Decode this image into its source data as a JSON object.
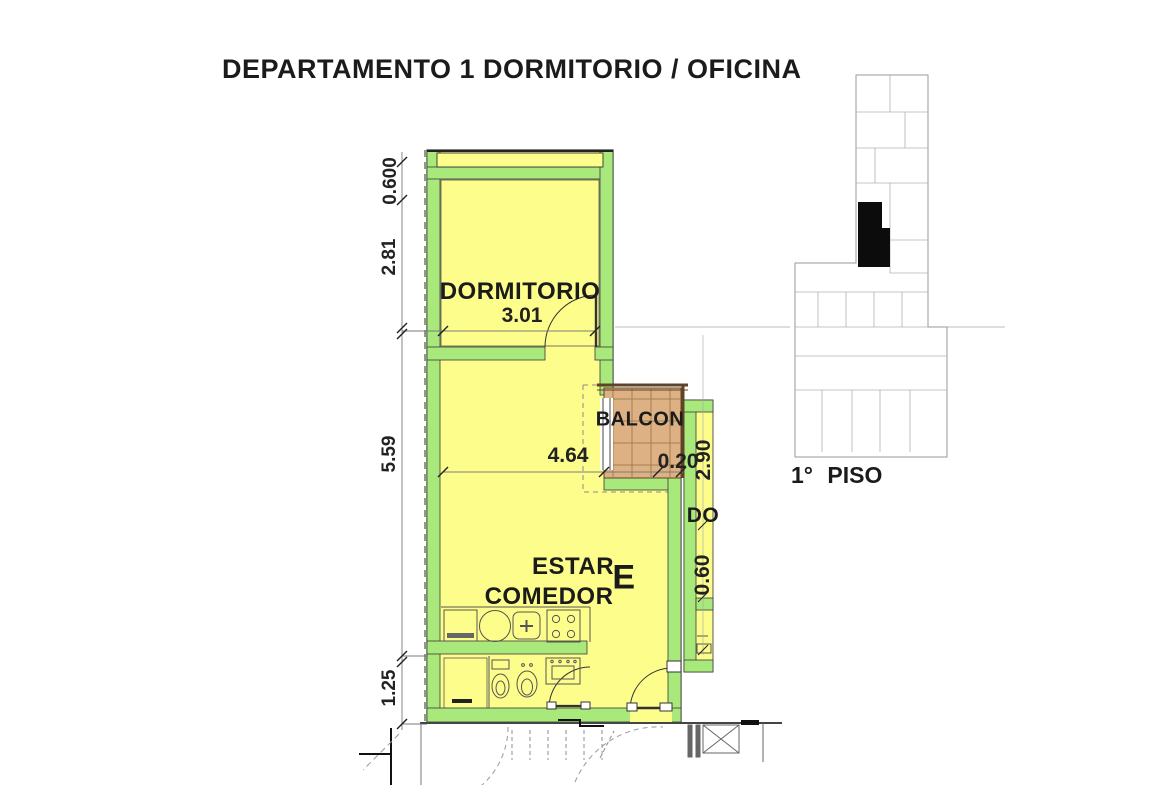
{
  "title": "DEPARTAMENTO 1 DORMITORIO / OFICINA",
  "plan": {
    "rooms": {
      "dormitorio": "DORMITORIO",
      "estar_line1": "ESTAR",
      "estar_line2": "COMEDOR",
      "estar_letter": "E",
      "balcony": "BALCON",
      "adjacent_partial": "DO"
    },
    "dimensions": {
      "left_chain": [
        "0.600",
        "2.81",
        "5.59",
        "1.25"
      ],
      "dormitorio_width": "3.01",
      "estar_width": "4.64",
      "balcony_edge": "0.20",
      "adjacent_height": "2.90",
      "adjacent_passage": "0.60"
    }
  },
  "keyplan": {
    "floor_label": "1° PISO"
  },
  "colors": {
    "room_fill": "#FDFD8C",
    "wall_fill": "#A9E97C",
    "balcony_fill": "#DDB183",
    "balcony_grid": "#A37E4F",
    "unit_marker": "#0C0C0C",
    "keyplan_line": "#9A9A9A"
  }
}
